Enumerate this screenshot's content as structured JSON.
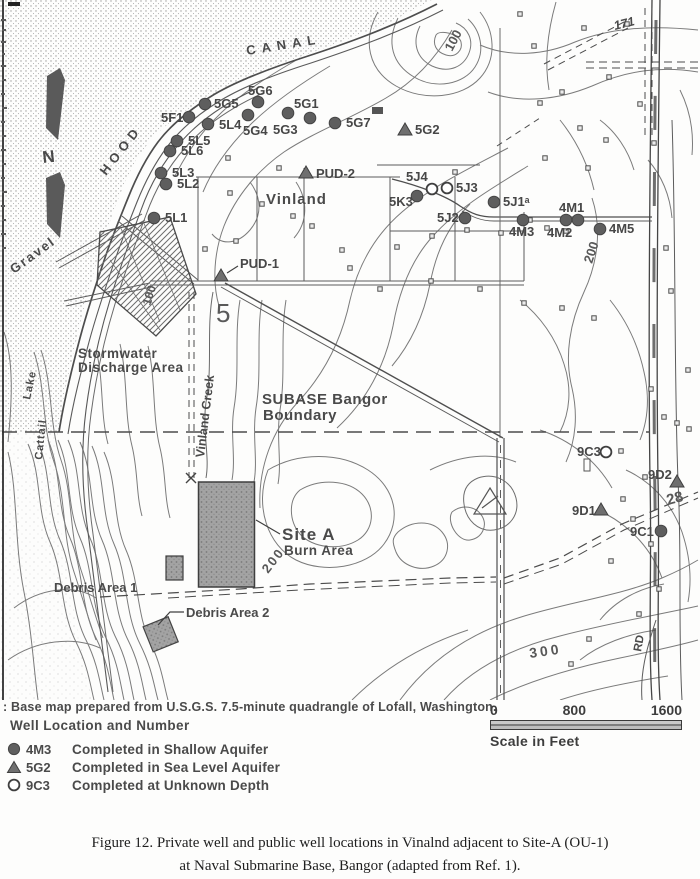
{
  "figure": {
    "base_note": ": Base map prepared from U.S.G.S. 7.5-minute quadrangle of Lofall, Washington.",
    "legend_title": "Well Location and Number",
    "legend_items": [
      {
        "symbol": "filled-circle",
        "code": "4M3",
        "desc": "Completed in Shallow Aquifer"
      },
      {
        "symbol": "triangle",
        "code": "5G2",
        "desc": "Completed in Sea Level Aquifer"
      },
      {
        "symbol": "open-circle",
        "code": "9C3",
        "desc": "Completed at Unknown Depth"
      }
    ],
    "scale_bar": {
      "tick0": "0",
      "tick1": "800",
      "tick2": "1600",
      "label": "Scale in Feet"
    },
    "caption_line1": "Figure 12.  Private well and public well locations in Vinalnd adjacent to Site-A (OU-1)",
    "caption_line2": "at Naval Submarine Base, Bangor (adapted from Ref. 1)."
  },
  "map": {
    "wells": [
      {
        "id": "5G6",
        "type": "shallow",
        "x": 258,
        "y": 102,
        "lx": 248,
        "ly": 95
      },
      {
        "id": "5G5",
        "type": "shallow",
        "x": 205,
        "y": 104,
        "lx": 214,
        "ly": 108
      },
      {
        "id": "5G1",
        "type": "shallow",
        "x": 310,
        "y": 118,
        "lx": 294,
        "ly": 108
      },
      {
        "id": "5F1",
        "type": "shallow",
        "x": 189,
        "y": 117,
        "lx": 161,
        "ly": 122
      },
      {
        "id": "5L4",
        "type": "shallow",
        "x": 208,
        "y": 124,
        "lx": 219,
        "ly": 129
      },
      {
        "id": "5G4",
        "type": "shallow",
        "x": 248,
        "y": 115,
        "lx": 243,
        "ly": 135
      },
      {
        "id": "5G3",
        "type": "shallow",
        "x": 288,
        "y": 113,
        "lx": 273,
        "ly": 134
      },
      {
        "id": "5G7",
        "type": "shallow",
        "x": 335,
        "y": 123,
        "lx": 346,
        "ly": 127
      },
      {
        "id": "5G2",
        "type": "sealevel",
        "x": 405,
        "y": 130,
        "lx": 415,
        "ly": 134
      },
      {
        "id": "5L5",
        "type": "shallow",
        "x": 177,
        "y": 141,
        "lx": 188,
        "ly": 145
      },
      {
        "id": "5L6",
        "type": "shallow",
        "x": 170,
        "y": 151,
        "lx": 181,
        "ly": 155
      },
      {
        "id": "5L3",
        "type": "shallow",
        "x": 161,
        "y": 173,
        "lx": 172,
        "ly": 177
      },
      {
        "id": "5L2",
        "type": "shallow",
        "x": 166,
        "y": 184,
        "lx": 177,
        "ly": 188
      },
      {
        "id": "5L1",
        "type": "shallow",
        "x": 154,
        "y": 218,
        "lx": 165,
        "ly": 222
      },
      {
        "id": "PUD-2",
        "type": "sealevel",
        "x": 306,
        "y": 173,
        "lx": 316,
        "ly": 178
      },
      {
        "id": "PUD-1",
        "type": "sealevel",
        "x": 221,
        "y": 276,
        "lx": 240,
        "ly": 268
      },
      {
        "id": "5J4",
        "type": "unknown",
        "x": 432,
        "y": 189,
        "lx": 406,
        "ly": 181
      },
      {
        "id": "5J3",
        "type": "unknown",
        "x": 447,
        "y": 188,
        "lx": 456,
        "ly": 192
      },
      {
        "id": "5K3",
        "type": "shallow",
        "x": 417,
        "y": 196,
        "lx": 389,
        "ly": 206
      },
      {
        "id": "5J1ᵃ",
        "type": "shallow",
        "x": 494,
        "y": 202,
        "lx": 503,
        "ly": 206
      },
      {
        "id": "5J2",
        "type": "shallow",
        "x": 465,
        "y": 218,
        "lx": 437,
        "ly": 222
      },
      {
        "id": "4M1",
        "type": "shallow",
        "x": 578,
        "y": 220,
        "lx": 559,
        "ly": 212
      },
      {
        "id": "4M2",
        "type": "shallow",
        "x": 566,
        "y": 220,
        "lx": 547,
        "ly": 237
      },
      {
        "id": "4M3",
        "type": "shallow",
        "x": 523,
        "y": 220,
        "lx": 509,
        "ly": 236
      },
      {
        "id": "4M5",
        "type": "shallow",
        "x": 600,
        "y": 229,
        "lx": 609,
        "ly": 233
      },
      {
        "id": "9C3",
        "type": "unknown",
        "x": 606,
        "y": 452,
        "lx": 577,
        "ly": 456
      },
      {
        "id": "9D2",
        "type": "sealevel",
        "x": 677,
        "y": 482,
        "lx": 648,
        "ly": 479
      },
      {
        "id": "9D1",
        "type": "sealevel",
        "x": 601,
        "y": 510,
        "lx": 572,
        "ly": 515
      },
      {
        "id": "9C1",
        "type": "shallow",
        "x": 661,
        "y": 531,
        "lx": 630,
        "ly": 536
      }
    ],
    "labels": [
      {
        "t": "CANAL",
        "x": 247,
        "y": 55,
        "s": 13,
        "r": -9,
        "ls": 6
      },
      {
        "t": "HOOD",
        "x": 106,
        "y": 176,
        "s": 13,
        "r": -52,
        "ls": 5
      },
      {
        "t": "N",
        "x": 43,
        "y": 163,
        "s": 17,
        "r": -6,
        "w": 700
      },
      {
        "t": "Gravel",
        "x": 14,
        "y": 274,
        "s": 13,
        "r": -36,
        "ls": 2
      },
      {
        "t": "Lake",
        "x": 30,
        "y": 400,
        "s": 11,
        "r": -78,
        "ls": 1
      },
      {
        "t": "Cattail",
        "x": 42,
        "y": 460,
        "s": 11,
        "r": -84,
        "ls": 1
      },
      {
        "t": "Stormwater",
        "x": 78,
        "y": 358,
        "s": 13.5,
        "ls": 0.5
      },
      {
        "t": "Discharge Area",
        "x": 78,
        "y": 372,
        "s": 13.5,
        "ls": 0.5
      },
      {
        "t": "Vinland Creek",
        "x": 204,
        "y": 458,
        "s": 12.5,
        "r": -83
      },
      {
        "t": "Vinland",
        "x": 266,
        "y": 204,
        "s": 15,
        "ls": 1,
        "w": 700
      },
      {
        "t": "SUBASE Bangor",
        "x": 262,
        "y": 404,
        "s": 15,
        "ls": 0.5,
        "w": 700
      },
      {
        "t": "Boundary",
        "x": 263,
        "y": 420,
        "s": 15,
        "ls": 0.5,
        "w": 700
      },
      {
        "t": "Site A",
        "x": 282,
        "y": 540,
        "s": 17,
        "ls": 1,
        "w": 800
      },
      {
        "t": "Burn Area",
        "x": 284,
        "y": 555,
        "s": 13.5,
        "ls": 0.5
      },
      {
        "t": "Debris Area 1",
        "x": 54,
        "y": 592,
        "s": 13
      },
      {
        "t": "Debris Area 2",
        "x": 186,
        "y": 617,
        "s": 13
      },
      {
        "t": "5",
        "x": 216,
        "y": 322,
        "s": 26,
        "w": 400,
        "c": "#5a5a5a"
      },
      {
        "t": "171",
        "x": 615,
        "y": 30,
        "s": 12.5,
        "r": -14,
        "i": 1
      },
      {
        "t": "RD",
        "x": 641,
        "y": 652,
        "s": 11.5,
        "r": -80,
        "w": 700
      },
      {
        "t": "100",
        "x": 452,
        "y": 52,
        "s": 13,
        "r": -62,
        "c": "#585858"
      },
      {
        "t": "100",
        "x": 150,
        "y": 306,
        "s": 12,
        "r": -72,
        "c": "#585858"
      },
      {
        "t": "200",
        "x": 592,
        "y": 264,
        "s": 13,
        "r": -72,
        "c": "#585858"
      },
      {
        "t": "200",
        "x": 268,
        "y": 574,
        "s": 13,
        "r": -52,
        "ls": 2,
        "c": "#585858"
      },
      {
        "t": "300",
        "x": 530,
        "y": 658,
        "s": 14,
        "r": -8,
        "ls": 3,
        "c": "#585858"
      },
      {
        "t": "28",
        "x": 668,
        "y": 505,
        "s": 15,
        "r": -15,
        "c": "#585858"
      }
    ],
    "buildings": [
      [
        520,
        14
      ],
      [
        534,
        46
      ],
      [
        584,
        28
      ],
      [
        562,
        92
      ],
      [
        540,
        103
      ],
      [
        580,
        128
      ],
      [
        609,
        77
      ],
      [
        545,
        158
      ],
      [
        588,
        168
      ],
      [
        627,
        24
      ],
      [
        230,
        193
      ],
      [
        262,
        204
      ],
      [
        293,
        216
      ],
      [
        312,
        226
      ],
      [
        236,
        241
      ],
      [
        342,
        250
      ],
      [
        397,
        247
      ],
      [
        432,
        236
      ],
      [
        467,
        230
      ],
      [
        501,
        233
      ],
      [
        547,
        228
      ],
      [
        566,
        231
      ],
      [
        228,
        158
      ],
      [
        279,
        168
      ],
      [
        205,
        249
      ],
      [
        350,
        268
      ],
      [
        380,
        289
      ],
      [
        480,
        289
      ],
      [
        524,
        303
      ],
      [
        562,
        308
      ],
      [
        594,
        318
      ],
      [
        640,
        104
      ],
      [
        654,
        143
      ],
      [
        666,
        248
      ],
      [
        671,
        291
      ],
      [
        651,
        389
      ],
      [
        664,
        417
      ],
      [
        677,
        423
      ],
      [
        689,
        429
      ],
      [
        621,
        451
      ],
      [
        645,
        477
      ],
      [
        623,
        499
      ],
      [
        633,
        519
      ],
      [
        651,
        544
      ],
      [
        611,
        561
      ],
      [
        659,
        589
      ],
      [
        639,
        614
      ],
      [
        589,
        639
      ],
      [
        571,
        664
      ],
      [
        431,
        281
      ],
      [
        455,
        172
      ],
      [
        606,
        140
      ],
      [
        530,
        220
      ],
      [
        688,
        370
      ]
    ]
  }
}
